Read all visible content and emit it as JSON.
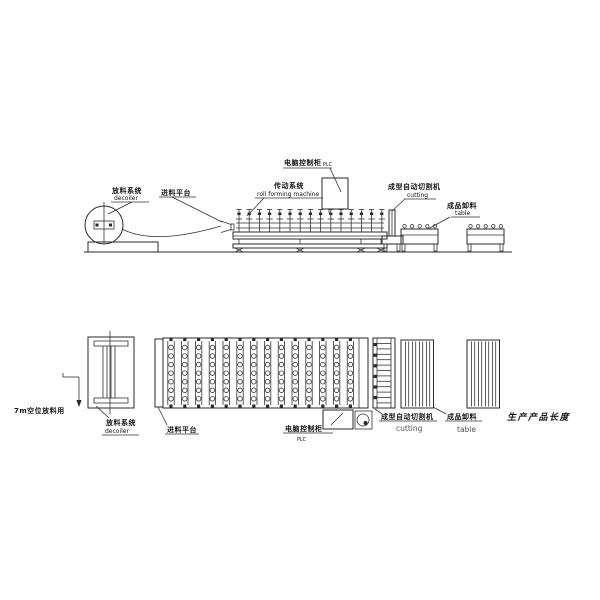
{
  "page": {
    "background": "#ffffff",
    "ink": "#2a2a2a",
    "description": "Two-view engineering diagram (side elevation and plan view) of a roll forming machine production line"
  },
  "elevation": {
    "decoiler": {
      "cn": "放料系统",
      "en": "decoiler"
    },
    "feed_platform": {
      "cn": "进料平台"
    },
    "drive": {
      "cn": "传动系统",
      "en": "roll forming machine"
    },
    "plc": {
      "cn": "电脑控制柜",
      "en": "PLC"
    },
    "cutting": {
      "cn": "成型自动切割机",
      "en": "cutting"
    },
    "table": {
      "cn": "成品卸料",
      "en": "table"
    }
  },
  "plan": {
    "decoiler": {
      "cn": "放料系统",
      "en": "decoiler"
    },
    "feed_platform": {
      "cn": "进料平台"
    },
    "plc": {
      "cn": "电脑控制柜",
      "en": "PLC"
    },
    "cutting": {
      "cn": "成型自动切割机",
      "en": "cutting"
    },
    "table": {
      "cn": "成品卸料",
      "en": "table"
    },
    "clearance_note": "7m空位放料用",
    "product_length_note": "生产产品长度"
  },
  "structure": {
    "elevation_roller_stands": 15,
    "plan_roller_columns": 14,
    "rollers_per_column": 7,
    "table_top_rollers": 5,
    "cutting_rungs": 12,
    "cutting_left_blocks": 6,
    "table_slat_pairs": 4,
    "tables": 2
  }
}
